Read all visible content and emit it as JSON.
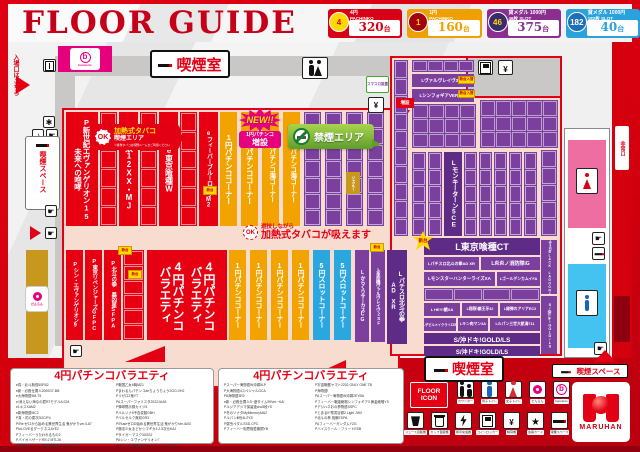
{
  "header": {
    "title": "FLOOR GUIDE",
    "badges": [
      {
        "circle": "4",
        "circle_bg": "#ffd900",
        "circle_fg": "#d80016",
        "line1": "4円",
        "line2": "PACHINKO",
        "count": "320",
        "unit": "台",
        "color": "#d80016",
        "count_color": "#d80016"
      },
      {
        "circle": "1",
        "circle_bg": "#a5000e",
        "circle_fg": "#ffd900",
        "line1": "1円",
        "line2": "PACHINKO",
        "count": "160",
        "unit": "台",
        "color": "#ef9f00",
        "count_color": "#ef9f00"
      },
      {
        "circle": "46",
        "circle_bg": "#3a2b6b",
        "circle_fg": "#ffd900",
        "line1": "貸メダル 1000円",
        "line2": "46枚 SLOT",
        "count": "375",
        "unit": "台",
        "color": "#8a2f90",
        "count_color": "#8a2f90"
      },
      {
        "circle": "182",
        "circle_bg": "#1d6fb8",
        "circle_fg": "#ffffff",
        "line1": "貸メダル 1000円",
        "line2": "182枚 SLOT",
        "count": "40",
        "unit": "台",
        "color": "#2aa3dc",
        "count_color": "#2aa3dc"
      }
    ]
  },
  "map": {
    "entrance": "入場口はこちら",
    "brand": "bancierto",
    "smoking_room": "喫煙室",
    "smoking_space": "喫煙スペース",
    "exit": "非常口",
    "danran": "だんらん",
    "green_info": "スマスロ設置",
    "center_ok": "OK",
    "new_badge": {
      "top": "NEW!!",
      "mid": "1円パチンコ",
      "bottom": "増設"
    },
    "heated_bubble": {
      "ok": "OK",
      "line1": "加熱式タバコ",
      "line2": "喫煙エリア",
      "caption": "※紙巻タバコは喫煙ルームをご利用ください"
    },
    "no_smoking": "禁煙エリア",
    "center_note": {
      "small": "遊技しながら",
      "large": "加熱式タバコが吸えます"
    },
    "expand_tag": "増設",
    "columns": [
      {
        "x": 66,
        "y": 112,
        "w": 32,
        "h": 114,
        "c": "red",
        "label": "P新世紀エヴァンゲリオン15|未来への咆哮",
        "fs": 7.5
      },
      {
        "x": 119,
        "y": 112,
        "w": 19,
        "h": 114,
        "c": "red",
        "label": "e牙狼12XX・MJ",
        "fs": 8
      },
      {
        "x": 159,
        "y": 112,
        "w": 19,
        "h": 114,
        "c": "red",
        "label": "e東京喰種W",
        "fs": 8
      },
      {
        "x": 199,
        "y": 112,
        "w": 19,
        "h": 114,
        "c": "red",
        "label": "eフィーバーブルーロックM2",
        "fs": 6
      },
      {
        "x": 220,
        "y": 112,
        "w": 17,
        "h": 114,
        "c": "yellow",
        "label": "1円パチンココーナー",
        "fs": 7.5
      },
      {
        "x": 241,
        "y": 112,
        "w": 17,
        "h": 114,
        "c": "yellow",
        "label": "1円パチンココーナー",
        "fs": 7.5
      },
      {
        "x": 262,
        "y": 112,
        "w": 17,
        "h": 114,
        "c": "yellow",
        "label": "1円パチンコ海コーナー",
        "fs": 6.5
      },
      {
        "x": 283,
        "y": 112,
        "w": 17,
        "h": 114,
        "c": "yellow",
        "label": "1円パチンコ海コーナー",
        "fs": 6.5
      },
      {
        "x": 346,
        "y": 172,
        "w": 14,
        "h": 22,
        "c": "gold",
        "label": "ジャグラー",
        "fs": 3.5
      },
      {
        "x": 66,
        "y": 250,
        "w": 17,
        "h": 90,
        "c": "red",
        "label": "Pシン・エヴァンゲリオン9",
        "fs": 5.5
      },
      {
        "x": 85,
        "y": 250,
        "w": 17,
        "h": 90,
        "c": "red",
        "label": "P東京リベンジャーズGFPC",
        "fs": 5.5
      },
      {
        "x": 104,
        "y": 250,
        "w": 17,
        "h": 90,
        "c": "red",
        "label": "P北斗の拳 暴凶星SFPA",
        "fs": 5.5
      },
      {
        "x": 147,
        "y": 250,
        "w": 80,
        "h": 90,
        "c": "red",
        "label": "4円パチンコ|バラエティ",
        "fs": 12,
        "dbl": true
      },
      {
        "x": 229,
        "y": 250,
        "w": 17,
        "h": 90,
        "c": "yellow",
        "label": "1円パチンココーナー",
        "fs": 7
      },
      {
        "x": 250,
        "y": 250,
        "w": 17,
        "h": 90,
        "c": "yellow",
        "label": "1円パチンココーナー",
        "fs": 7
      },
      {
        "x": 271,
        "y": 250,
        "w": 17,
        "h": 90,
        "c": "yellow",
        "label": "1円パチンココーナー",
        "fs": 7
      },
      {
        "x": 292,
        "y": 250,
        "w": 17,
        "h": 90,
        "c": "yellow",
        "label": "1円パチンココーナー",
        "fs": 7
      },
      {
        "x": 313,
        "y": 250,
        "w": 17,
        "h": 90,
        "c": "blue",
        "label": "5円スロットコーナー",
        "fs": 7
      },
      {
        "x": 334,
        "y": 250,
        "w": 17,
        "h": 90,
        "c": "blue",
        "label": "5円スロットコーナー",
        "fs": 7
      },
      {
        "x": 355,
        "y": 250,
        "w": 14,
        "h": 92,
        "c": "purple",
        "label": "LからくりサーカスCG",
        "fs": 5
      },
      {
        "x": 371,
        "y": 250,
        "w": 14,
        "h": 92,
        "c": "purple",
        "label": "L革命機ヴァルヴレイヴ2SF",
        "fs": 4.5
      },
      {
        "x": 387,
        "y": 250,
        "w": 20,
        "h": 94,
        "c": "purpledark",
        "label": "Lパチスロ北斗の拳|AD XR",
        "fs": 6
      },
      {
        "x": 444,
        "y": 152,
        "w": 18,
        "h": 84,
        "c": "purpledark",
        "label": "Lモンキーターン5CE",
        "fs": 6.5
      },
      {
        "x": 541,
        "y": 240,
        "w": 16,
        "h": 54,
        "c": "purple",
        "label": "スマスロBLACK LAGOON4",
        "fs": 3.3
      },
      {
        "x": 541,
        "y": 296,
        "w": 16,
        "h": 58,
        "c": "purple",
        "label": "S/沖ドキ!GOLD/LS",
        "fs": 3.8
      }
    ],
    "boxcols": [
      {
        "x": 100,
        "y": 112,
        "w": 17,
        "h": 114,
        "c": "red",
        "n": 6
      },
      {
        "x": 140,
        "y": 112,
        "w": 17,
        "h": 114,
        "c": "red",
        "n": 6
      },
      {
        "x": 180,
        "y": 112,
        "w": 17,
        "h": 114,
        "c": "red",
        "n": 6
      },
      {
        "x": 304,
        "y": 112,
        "w": 17,
        "h": 114,
        "c": "purple",
        "n": 7
      },
      {
        "x": 325,
        "y": 112,
        "w": 17,
        "h": 114,
        "c": "purple",
        "n": 7
      },
      {
        "x": 346,
        "y": 112,
        "w": 17,
        "h": 114,
        "c": "purple",
        "n": 7
      },
      {
        "x": 367,
        "y": 112,
        "w": 17,
        "h": 114,
        "c": "purple",
        "n": 7
      },
      {
        "x": 123,
        "y": 250,
        "w": 21,
        "h": 90,
        "c": "red",
        "n": 6
      },
      {
        "x": 394,
        "y": 60,
        "w": 14,
        "h": 176,
        "c": "purple",
        "n": 10
      },
      {
        "x": 412,
        "y": 152,
        "w": 14,
        "h": 84,
        "c": "purple",
        "n": 5
      },
      {
        "x": 428,
        "y": 152,
        "w": 14,
        "h": 84,
        "c": "purple",
        "n": 5
      },
      {
        "x": 464,
        "y": 152,
        "w": 13,
        "h": 84,
        "c": "purple",
        "n": 5
      },
      {
        "x": 479,
        "y": 152,
        "w": 13,
        "h": 84,
        "c": "purple",
        "n": 5
      },
      {
        "x": 494,
        "y": 152,
        "w": 13,
        "h": 84,
        "c": "purple",
        "n": 5
      },
      {
        "x": 509,
        "y": 152,
        "w": 13,
        "h": 84,
        "c": "purple",
        "n": 5
      },
      {
        "x": 524,
        "y": 152,
        "w": 13,
        "h": 84,
        "c": "purple",
        "n": 5
      },
      {
        "x": 541,
        "y": 150,
        "w": 16,
        "h": 86,
        "c": "purple",
        "n": 5
      }
    ],
    "grids": [
      {
        "x": 412,
        "y": 60,
        "w": 62,
        "h": 12,
        "c": "purple",
        "cols": 4,
        "rows": 1
      },
      {
        "x": 412,
        "y": 104,
        "w": 64,
        "h": 44,
        "c": "purple",
        "cols": 4,
        "rows": 3
      },
      {
        "x": 480,
        "y": 100,
        "w": 78,
        "h": 48,
        "c": "purple",
        "cols": 5,
        "rows": 3
      },
      {
        "x": 424,
        "y": 288,
        "w": 116,
        "h": 13,
        "c": "purple",
        "cols": 4,
        "rows": 1
      }
    ],
    "bars": [
      {
        "x": 412,
        "y": 74,
        "w": 62,
        "h": 13,
        "c": "purple",
        "label": "Lヴァルヴレイヴ3BA",
        "fs": 4.5
      },
      {
        "x": 412,
        "y": 89,
        "w": 62,
        "h": 13,
        "c": "purple",
        "label": "LシンフォギアVER/BM",
        "fs": 4.5
      },
      {
        "x": 424,
        "y": 238,
        "w": 116,
        "h": 17,
        "c": "purpledark",
        "label": "L東京喰種CT",
        "fs": 9
      },
      {
        "x": 424,
        "y": 257,
        "w": 55,
        "h": 13,
        "c": "purple",
        "label": "Lパチスロ北斗の拳AD XR",
        "fs": 4
      },
      {
        "x": 481,
        "y": 257,
        "w": 59,
        "h": 13,
        "c": "purple",
        "label": "L炎炎ノ消防隊iG",
        "fs": 5
      },
      {
        "x": 424,
        "y": 272,
        "w": 71,
        "h": 14,
        "c": "purple",
        "label": "LモンスターハンターライズXA",
        "fs": 4.5
      },
      {
        "x": 497,
        "y": 272,
        "w": 43,
        "h": 14,
        "c": "purple",
        "label": "LゴールデンカムイFA",
        "fs": 3.8
      },
      {
        "x": 424,
        "y": 303,
        "w": 36,
        "h": 13,
        "c": "purple",
        "label": "L HEY!鏡XA",
        "fs": 4
      },
      {
        "x": 462,
        "y": 303,
        "w": 36,
        "h": 13,
        "c": "purple",
        "label": "L翔裂!覇王牙32",
        "fs": 3.8
      },
      {
        "x": 500,
        "y": 303,
        "w": 40,
        "h": 13,
        "c": "purple",
        "label": "L緋弾のアリアEC2",
        "fs": 3.8
      },
      {
        "x": 424,
        "y": 318,
        "w": 32,
        "h": 13,
        "c": "purple",
        "label": "LデビルメイクライZZB",
        "fs": 3.2
      },
      {
        "x": 458,
        "y": 318,
        "w": 30,
        "h": 13,
        "c": "purple",
        "label": "Lキン肉マン3A",
        "fs": 3.8
      },
      {
        "x": 490,
        "y": 318,
        "w": 50,
        "h": 13,
        "c": "purple",
        "label": "Lルパン三世大航海711",
        "fs": 3.8
      },
      {
        "x": 424,
        "y": 333,
        "w": 116,
        "h": 11,
        "c": "purpledark",
        "label": "S/沖ドキ!GOLD/LS",
        "fs": 6.5
      },
      {
        "x": 424,
        "y": 346,
        "w": 116,
        "h": 10,
        "c": "purpledark",
        "label": "S/沖ドキ!GOLD/LS",
        "fs": 6
      }
    ],
    "tags": [
      {
        "x": 203,
        "y": 186,
        "w": 14,
        "h": 9,
        "t": "新台"
      },
      {
        "x": 370,
        "y": 243,
        "w": 14,
        "h": 9,
        "t": "新台"
      },
      {
        "x": 118,
        "y": 246,
        "w": 14,
        "h": 9,
        "t": "新台"
      },
      {
        "x": 128,
        "y": 270,
        "w": 14,
        "h": 9,
        "t": "新台"
      },
      {
        "x": 458,
        "y": 76,
        "w": 17,
        "h": 8,
        "t": "新台入替"
      },
      {
        "x": 458,
        "y": 90,
        "w": 17,
        "h": 8,
        "t": "新台入替"
      }
    ],
    "bursts": [
      {
        "x": 412,
        "y": 231,
        "w": 22,
        "h": 20,
        "t": "新台"
      }
    ]
  },
  "legend1": {
    "title": "4円パチンコバラエティ",
    "col1": [
      "e真・北斗無双5SR02",
      "e新・必殺仕置人2000GT-BB",
      "e大海物語5M-T5",
      "e/消えない海なの君RTモデル/LS24",
      "e1キスXAM2",
      "e新海物語MC2",
      "P真・花の慶次3GC/P4",
      "P/Re:ゼロから始める異世界生活 鬼がかりver./L87",
      "PtoLOVEるダークネスAYE2",
      "Pフィーバーうたわれるもの2",
      "PバイオハザードRE:2 MTL26",
      "P緋弾のアリア・緋緋神降臨~199Ver.7Q6"
    ],
    "col2": [
      "P戦国乙女6暁MZ1",
      "Pまわるんパチンコdeちょうちょう2GO-VH2",
      "Pリゼロ2鬼YT",
      "PAスーパーファミスタ2022JUA5",
      "P弾球黙示録カイジ5",
      "Pペルソナ5予告変動GBH",
      "Pべルセルク無双GR3",
      "P/RuseゼロD始める異世界生活 鬼がかりVer./A03",
      "P魔法少女まどか☆マギカ3 2.5次元KAJ",
      "Pタイガーマスク3XSSJ",
      "PAシン・エヴァンゲリオン7",
      "Pデジハネ新鬼武者2サイドバイン255PB"
    ]
  },
  "legend2": {
    "title": "4円パチンコバラエティ",
    "col1": [
      "Pスーパー海物語IN沖縄5LP",
      "P大海物語4スペシャルGCA",
      "PA海物語3R2",
      "e新・必殺仕置人S~遊タイム99Ver.~KA!",
      "Pルジアデジマ保留連cho5段YS",
      "P冬のソナタMyMemoryMA2",
      "PルパンⅢ世4LZY2!",
      "P弱虫ペダルSSD.CPC",
      "Pフィーバー相思相愛機関YB"
    ],
    "col2": [
      "P宇宙戦艦ヤマト2202 ONLY ONE TB",
      "P海物語!",
      "PAスーパー海物語IN沖縄2EYBA",
      "Pフィーバー戦姫絶唱シンフォギア3 黄金絶唱YS",
      "Pデジハネお぀の夢物語SSPC",
      "PとあるIF禁書目録2 Light JWX",
      "P北斗の拳 強敵ESPA",
      "PAフィーバーガンダムYZG",
      "Pハイスクール・フリートESB"
    ]
  },
  "floor_icons": {
    "line1": "FLOOR",
    "line2": "ICON",
    "row1": [
      {
        "icon": "counter",
        "label": "カウンター"
      },
      {
        "icon": "man",
        "label": "男子トイレ"
      },
      {
        "icon": "woman",
        "label": "女子トイレ"
      },
      {
        "icon": "danran",
        "label": "だんらん"
      },
      {
        "icon": "bancierto",
        "label": "bancierto"
      }
    ],
    "row2": [
      {
        "icon": "cup",
        "label": "ジュース自販機"
      },
      {
        "icon": "coffee",
        "label": "カップ自販機"
      },
      {
        "icon": "charge",
        "label": "携帯充電器"
      },
      {
        "icon": "locker",
        "label": "コインロッカー"
      },
      {
        "icon": "card",
        "label": "精算機"
      },
      {
        "icon": "star",
        "label": "会員カード"
      },
      {
        "icon": "smoke",
        "label": "喫煙スペース"
      }
    ]
  },
  "maruhan": {
    "label": "MARUHAN"
  }
}
